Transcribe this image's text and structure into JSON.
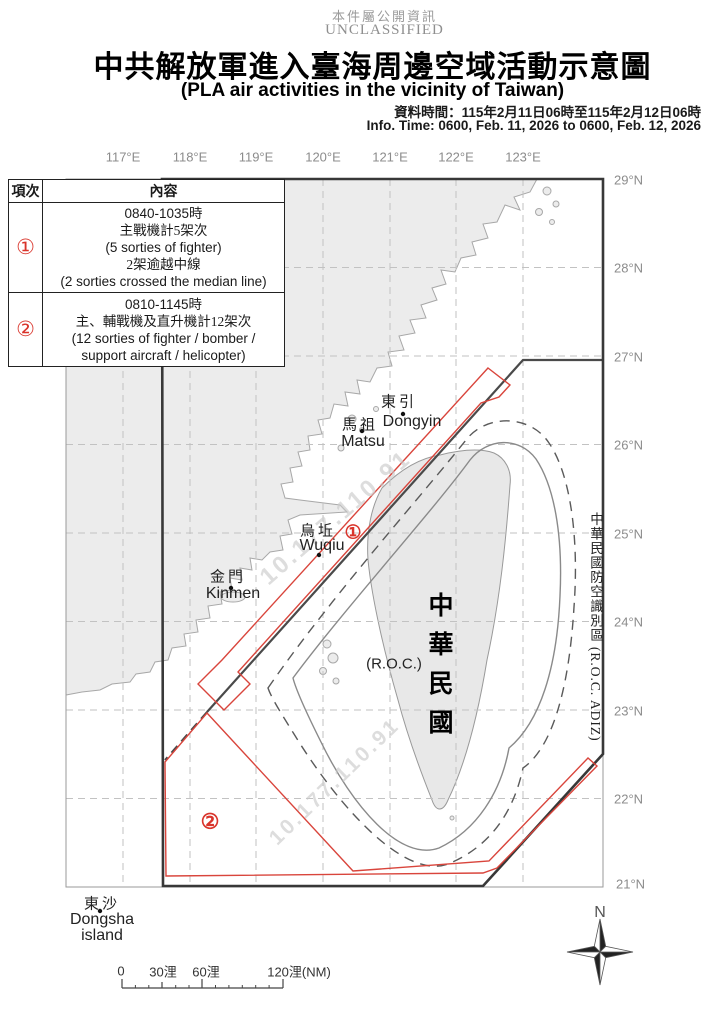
{
  "header": {
    "public_notice": "本件屬公開資訊",
    "classification": "UNCLASSIFIED",
    "title_zh": "中共解放軍進入臺海周邊空域活動示意圖",
    "title_en": "(PLA air activities in the vicinity of Taiwan)",
    "info_time_zh": "資料時間：115年2月11日06時至115年2月12日06時",
    "info_time_en": "Info. Time: 0600, Feb. 11, 2026 to 0600, Feb. 12, 2026"
  },
  "legend_table": {
    "headers": {
      "item": "項次",
      "content": "內容"
    },
    "rows": [
      {
        "id": "①",
        "lines": [
          "0840-1035時",
          "主戰機計5架次",
          "(5 sorties of fighter)",
          "2架逾越中線",
          "(2 sorties crossed the median line)"
        ]
      },
      {
        "id": "②",
        "lines": [
          "0810-1145時",
          "主、輔戰機及直升機計12架次",
          "(12 sorties of fighter / bomber /",
          "support aircraft / helicopter)"
        ]
      }
    ]
  },
  "map": {
    "lon_labels": [
      "117°E",
      "118°E",
      "119°E",
      "120°E",
      "121°E",
      "122°E",
      "123°E"
    ],
    "lat_labels": [
      "29°N",
      "28°N",
      "27°N",
      "26°N",
      "25°N",
      "24°N",
      "23°N",
      "22°N",
      "21°N"
    ],
    "places": {
      "dongyin_zh": "東引",
      "dongyin_en": "Dongyin",
      "matsu_zh": "馬祖",
      "matsu_en": "Matsu",
      "wuqiu_zh": "烏坵",
      "wuqiu_en": "Wuqiu",
      "kinmen_zh": "金門",
      "kinmen_en": "Kinmen",
      "dongsha_zh": "東沙",
      "dongsha_en_line1": "Dongsha",
      "dongsha_en_line2": "island",
      "taiwan_vertical": "中華民國",
      "taiwan_en": "(R.O.C.)",
      "adiz_vertical": "中華民國防空識別區 (R.O.C. ADIZ)"
    },
    "markers": {
      "area1": "①",
      "area2": "②"
    },
    "watermark": "10.177.110.91",
    "compass_label": "N"
  },
  "scale_bar": {
    "tick0": "0",
    "tick30": "30浬",
    "tick60": "60浬",
    "tick120": "120浬(NM)"
  },
  "colors": {
    "activity_red": "#d9453c",
    "adiz_line": "#383838",
    "median_line": "#4a4a4a",
    "land_fill": "#ececec",
    "grid_gray": "#c2c2c2",
    "label_gray": "#8c8c8c"
  }
}
